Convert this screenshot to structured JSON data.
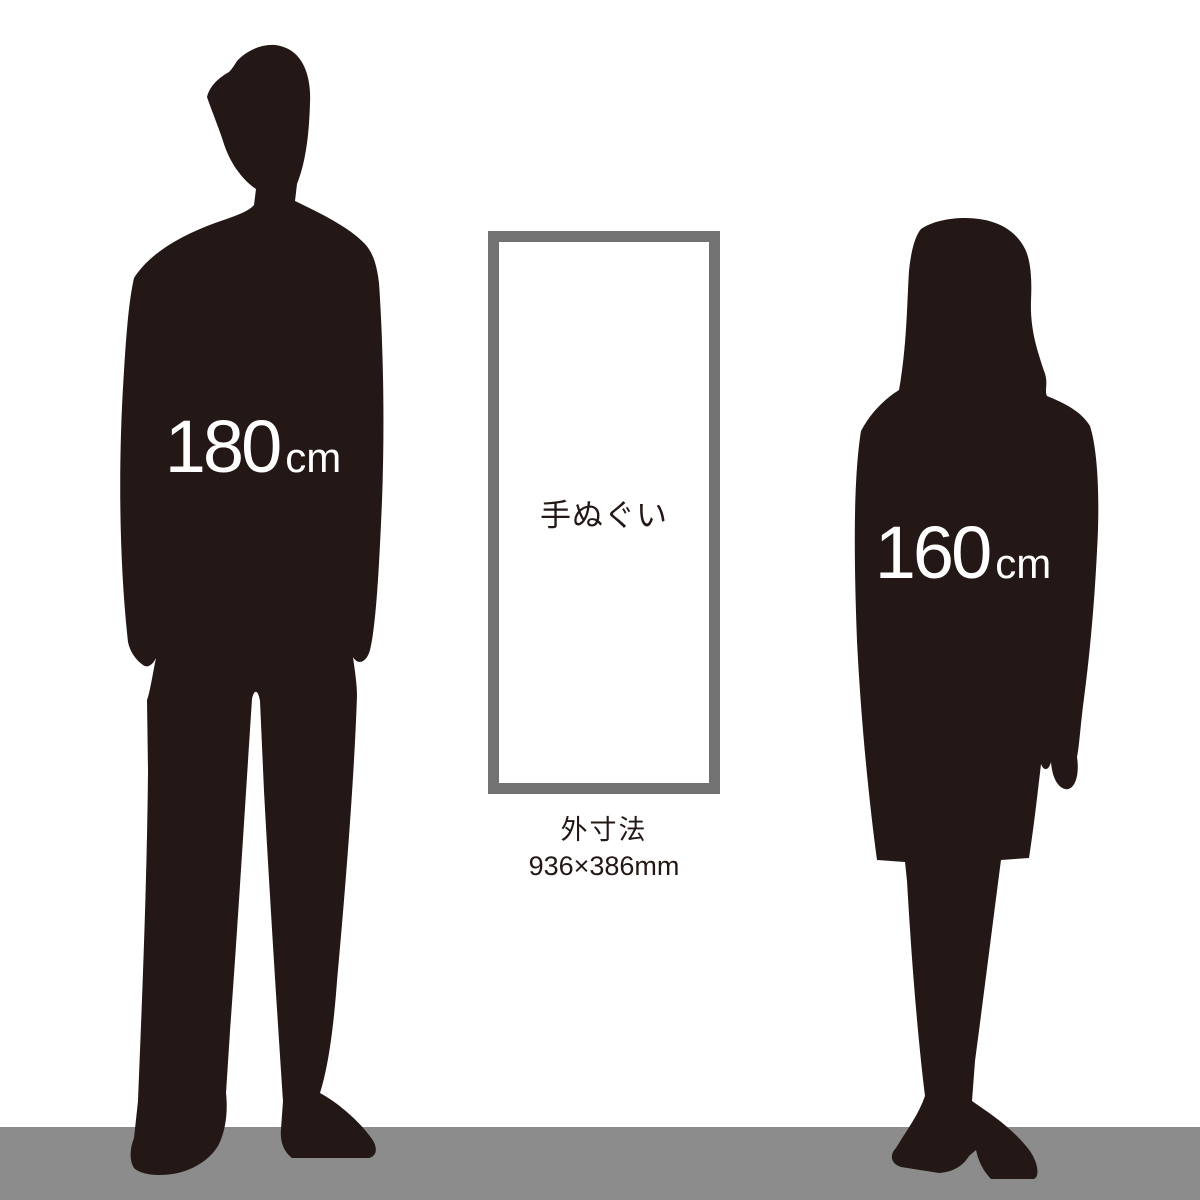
{
  "scene": {
    "background_color": "#ffffff",
    "silhouette_color": "#231815",
    "floor_color": "#8c8c8c",
    "frame_border_color": "#727272",
    "label_text_color": "#ffffff"
  },
  "man": {
    "height_value": "180",
    "height_unit": "cm"
  },
  "woman": {
    "height_value": "160",
    "height_unit": "cm"
  },
  "product": {
    "frame_label": "手ぬぐい",
    "dimension_label": "外寸法",
    "dimension_value": "936×386mm"
  }
}
